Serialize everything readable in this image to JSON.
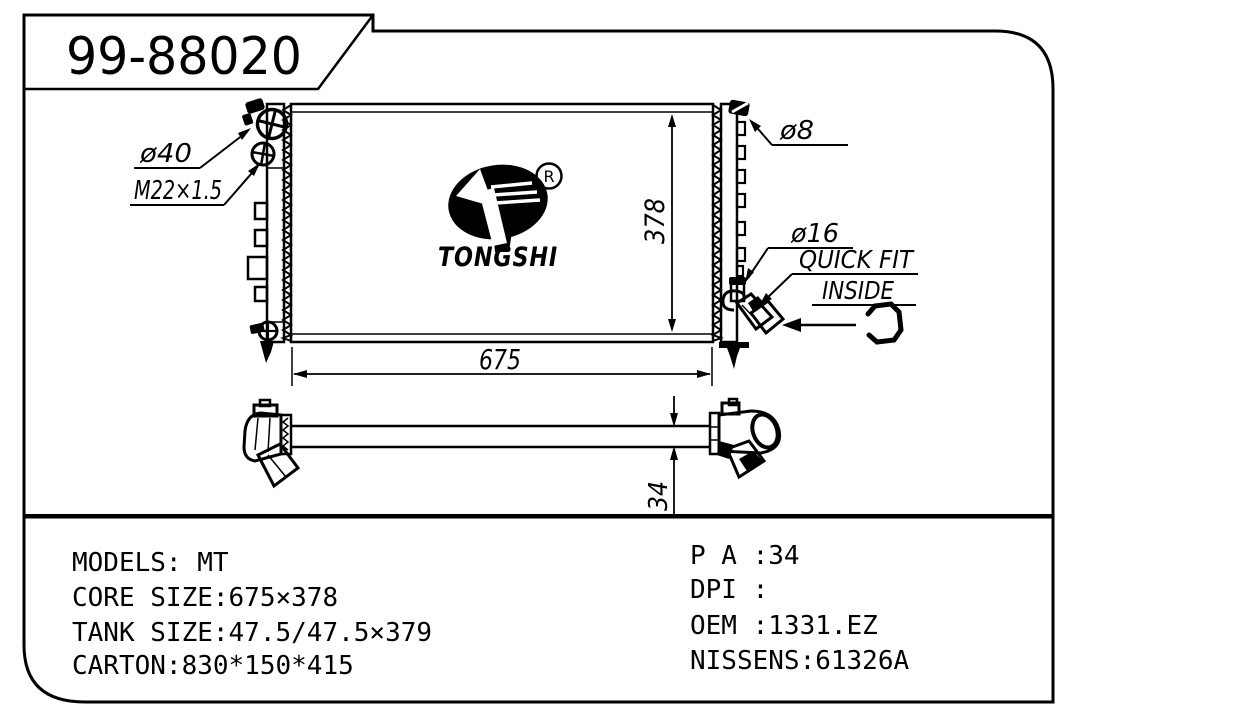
{
  "header": {
    "part_number": "99-88020"
  },
  "logo": {
    "brand": "TONGSHI",
    "registered_mark": "R"
  },
  "callouts": {
    "filler": "ø40",
    "drain_thread": "M22×1.5",
    "bleed": "ø8",
    "outlet": "ø16",
    "quick_fit": "QUICK FIT",
    "inside": "INSIDE"
  },
  "dimensions": {
    "core_height": "378",
    "core_width": "675",
    "thickness": "34"
  },
  "specs": {
    "left": [
      "MODELS:  MT",
      "CORE SIZE:675×378",
      "TANK SIZE:47.5/47.5×379",
      "CARTON:830*150*415"
    ],
    "right": [
      "P A :34",
      "DPI :",
      "OEM :1331.EZ",
      "NISSENS:61326A"
    ]
  },
  "colors": {
    "ink": "#000000",
    "background": "#ffffff"
  }
}
